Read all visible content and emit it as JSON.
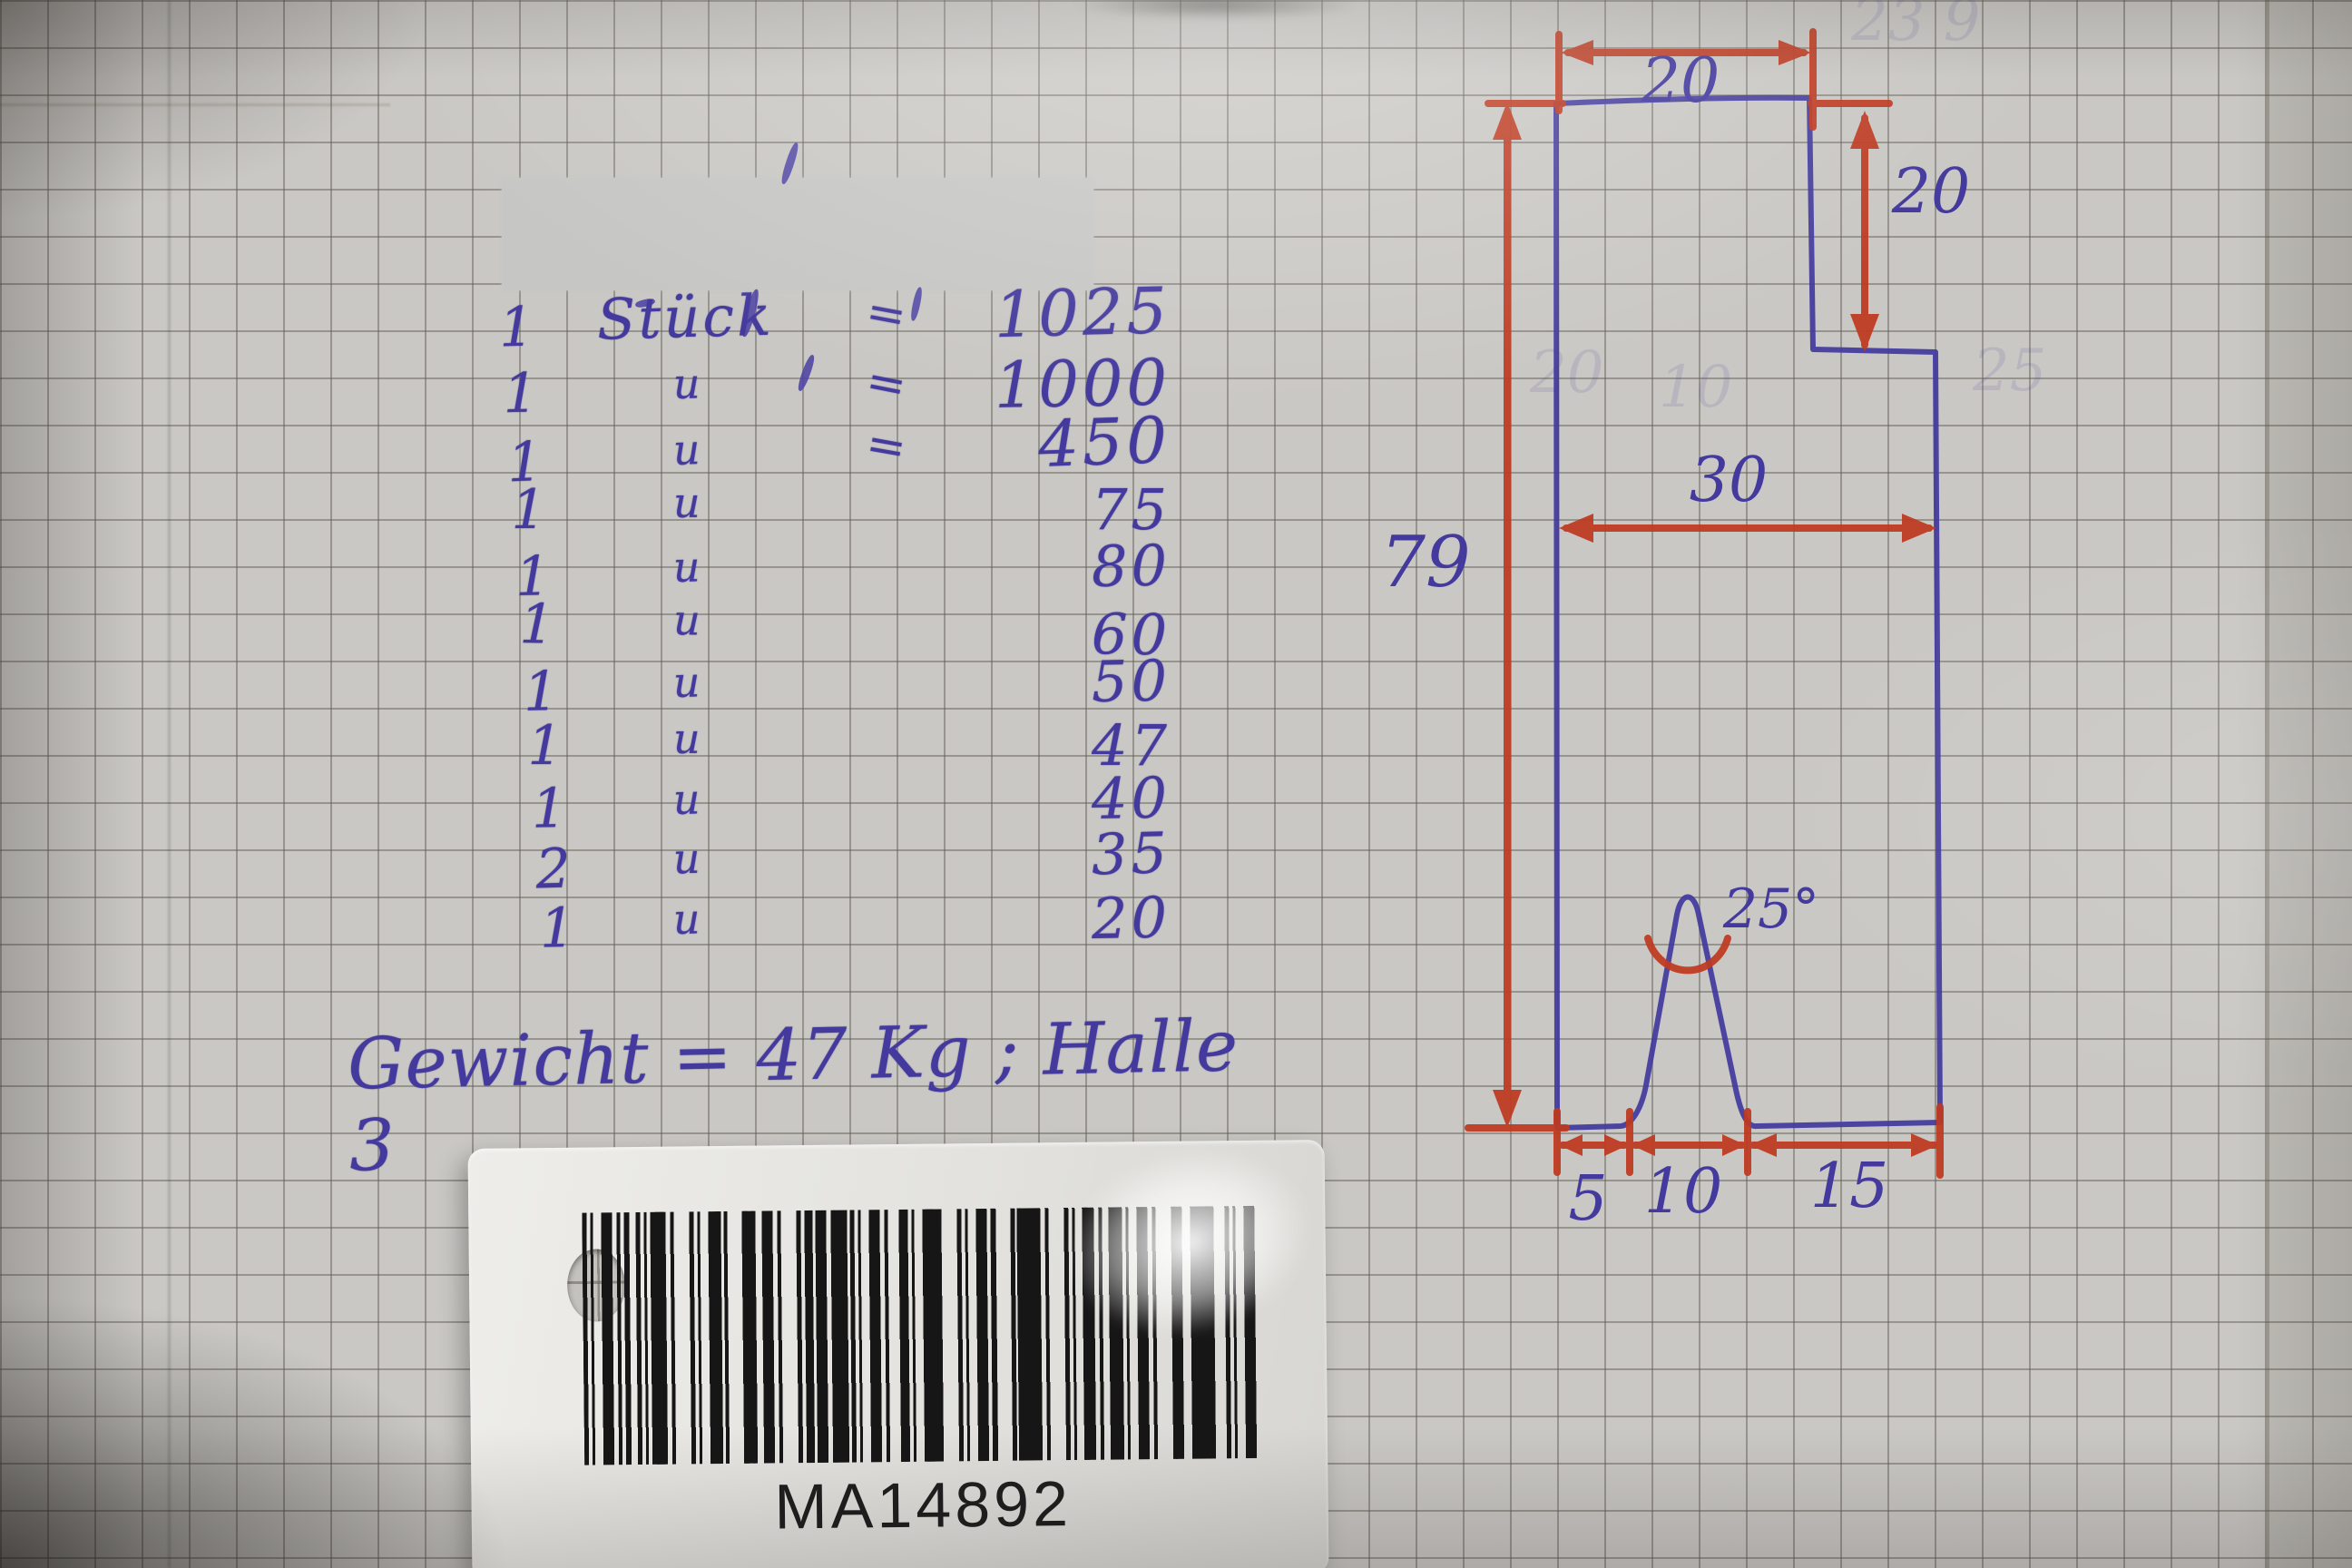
{
  "photo": {
    "paper_color": "#cac8c4",
    "ink_blue": "#443a9d",
    "ink_red": "#bf3a20"
  },
  "parts_list": {
    "rows": [
      {
        "qty": "1",
        "item": "Stück",
        "eq": "=",
        "value": "1025"
      },
      {
        "qty": "1",
        "item": "u",
        "eq": "=",
        "value": "1000"
      },
      {
        "qty": "1",
        "item": "u",
        "eq": "=",
        "value": "450"
      },
      {
        "qty": "1",
        "item": "u",
        "eq": "",
        "value": "75"
      },
      {
        "qty": "1",
        "item": "u",
        "eq": "",
        "value": "80"
      },
      {
        "qty": "1",
        "item": "u",
        "eq": "",
        "value": "60"
      },
      {
        "qty": "1",
        "item": "u",
        "eq": "",
        "value": "50"
      },
      {
        "qty": "1",
        "item": "u",
        "eq": "",
        "value": "47"
      },
      {
        "qty": "1",
        "item": "u",
        "eq": "",
        "value": "40"
      },
      {
        "qty": "2",
        "item": "u",
        "eq": "",
        "value": "35"
      },
      {
        "qty": "1",
        "item": "u",
        "eq": "",
        "value": "20"
      }
    ],
    "weight_note": "Gewicht = 47 Kg ; Halle 3"
  },
  "drawing": {
    "dim_top_width": "20",
    "dim_right_height": "20",
    "dim_mid_width": "30",
    "dim_total_height": "79",
    "dim_notch_angle": "25°",
    "dim_bottom_left": "5",
    "dim_bottom_mid": "10",
    "dim_bottom_right": "15"
  },
  "tag": {
    "code": "MA14892"
  },
  "ghost_marks": [
    "20",
    "10",
    "25",
    "23 9"
  ]
}
